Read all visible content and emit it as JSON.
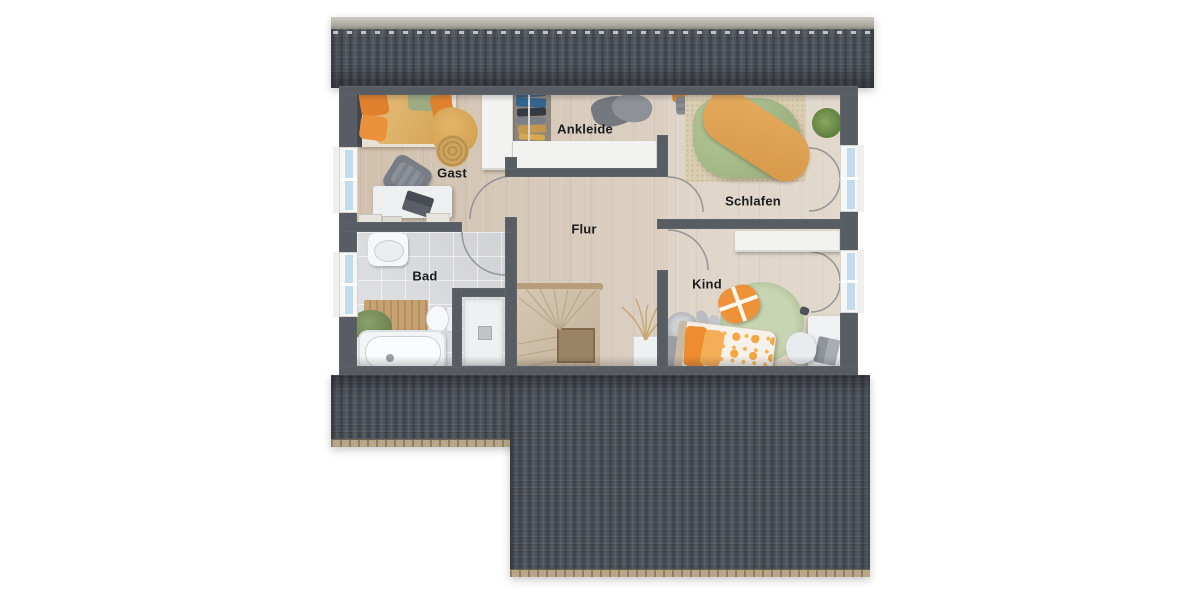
{
  "rooms": {
    "gast": {
      "label": "Gast"
    },
    "ankleide": {
      "label": "Ankleide"
    },
    "schlafen": {
      "label": "Schlafen"
    },
    "flur": {
      "label": "Flur"
    },
    "bad": {
      "label": "Bad"
    },
    "kind": {
      "label": "Kind"
    }
  },
  "colors": {
    "roof-dark": "#474b53",
    "roof-ridge": "#b5b2ab",
    "eave": "#b3a185",
    "wall": "#585c63",
    "wood": "#d5c7b4",
    "tile": "#d7d8da",
    "stair": "#cdbda6",
    "white-furn": "#f2f2f0",
    "label": "#1b1c1e",
    "glass": "#c3dcea",
    "accent-orange": "#ef9138",
    "duvet-green": "#a9bd8e",
    "rug-green": "#bccaa5",
    "blanket-tan": "#ddb169"
  }
}
